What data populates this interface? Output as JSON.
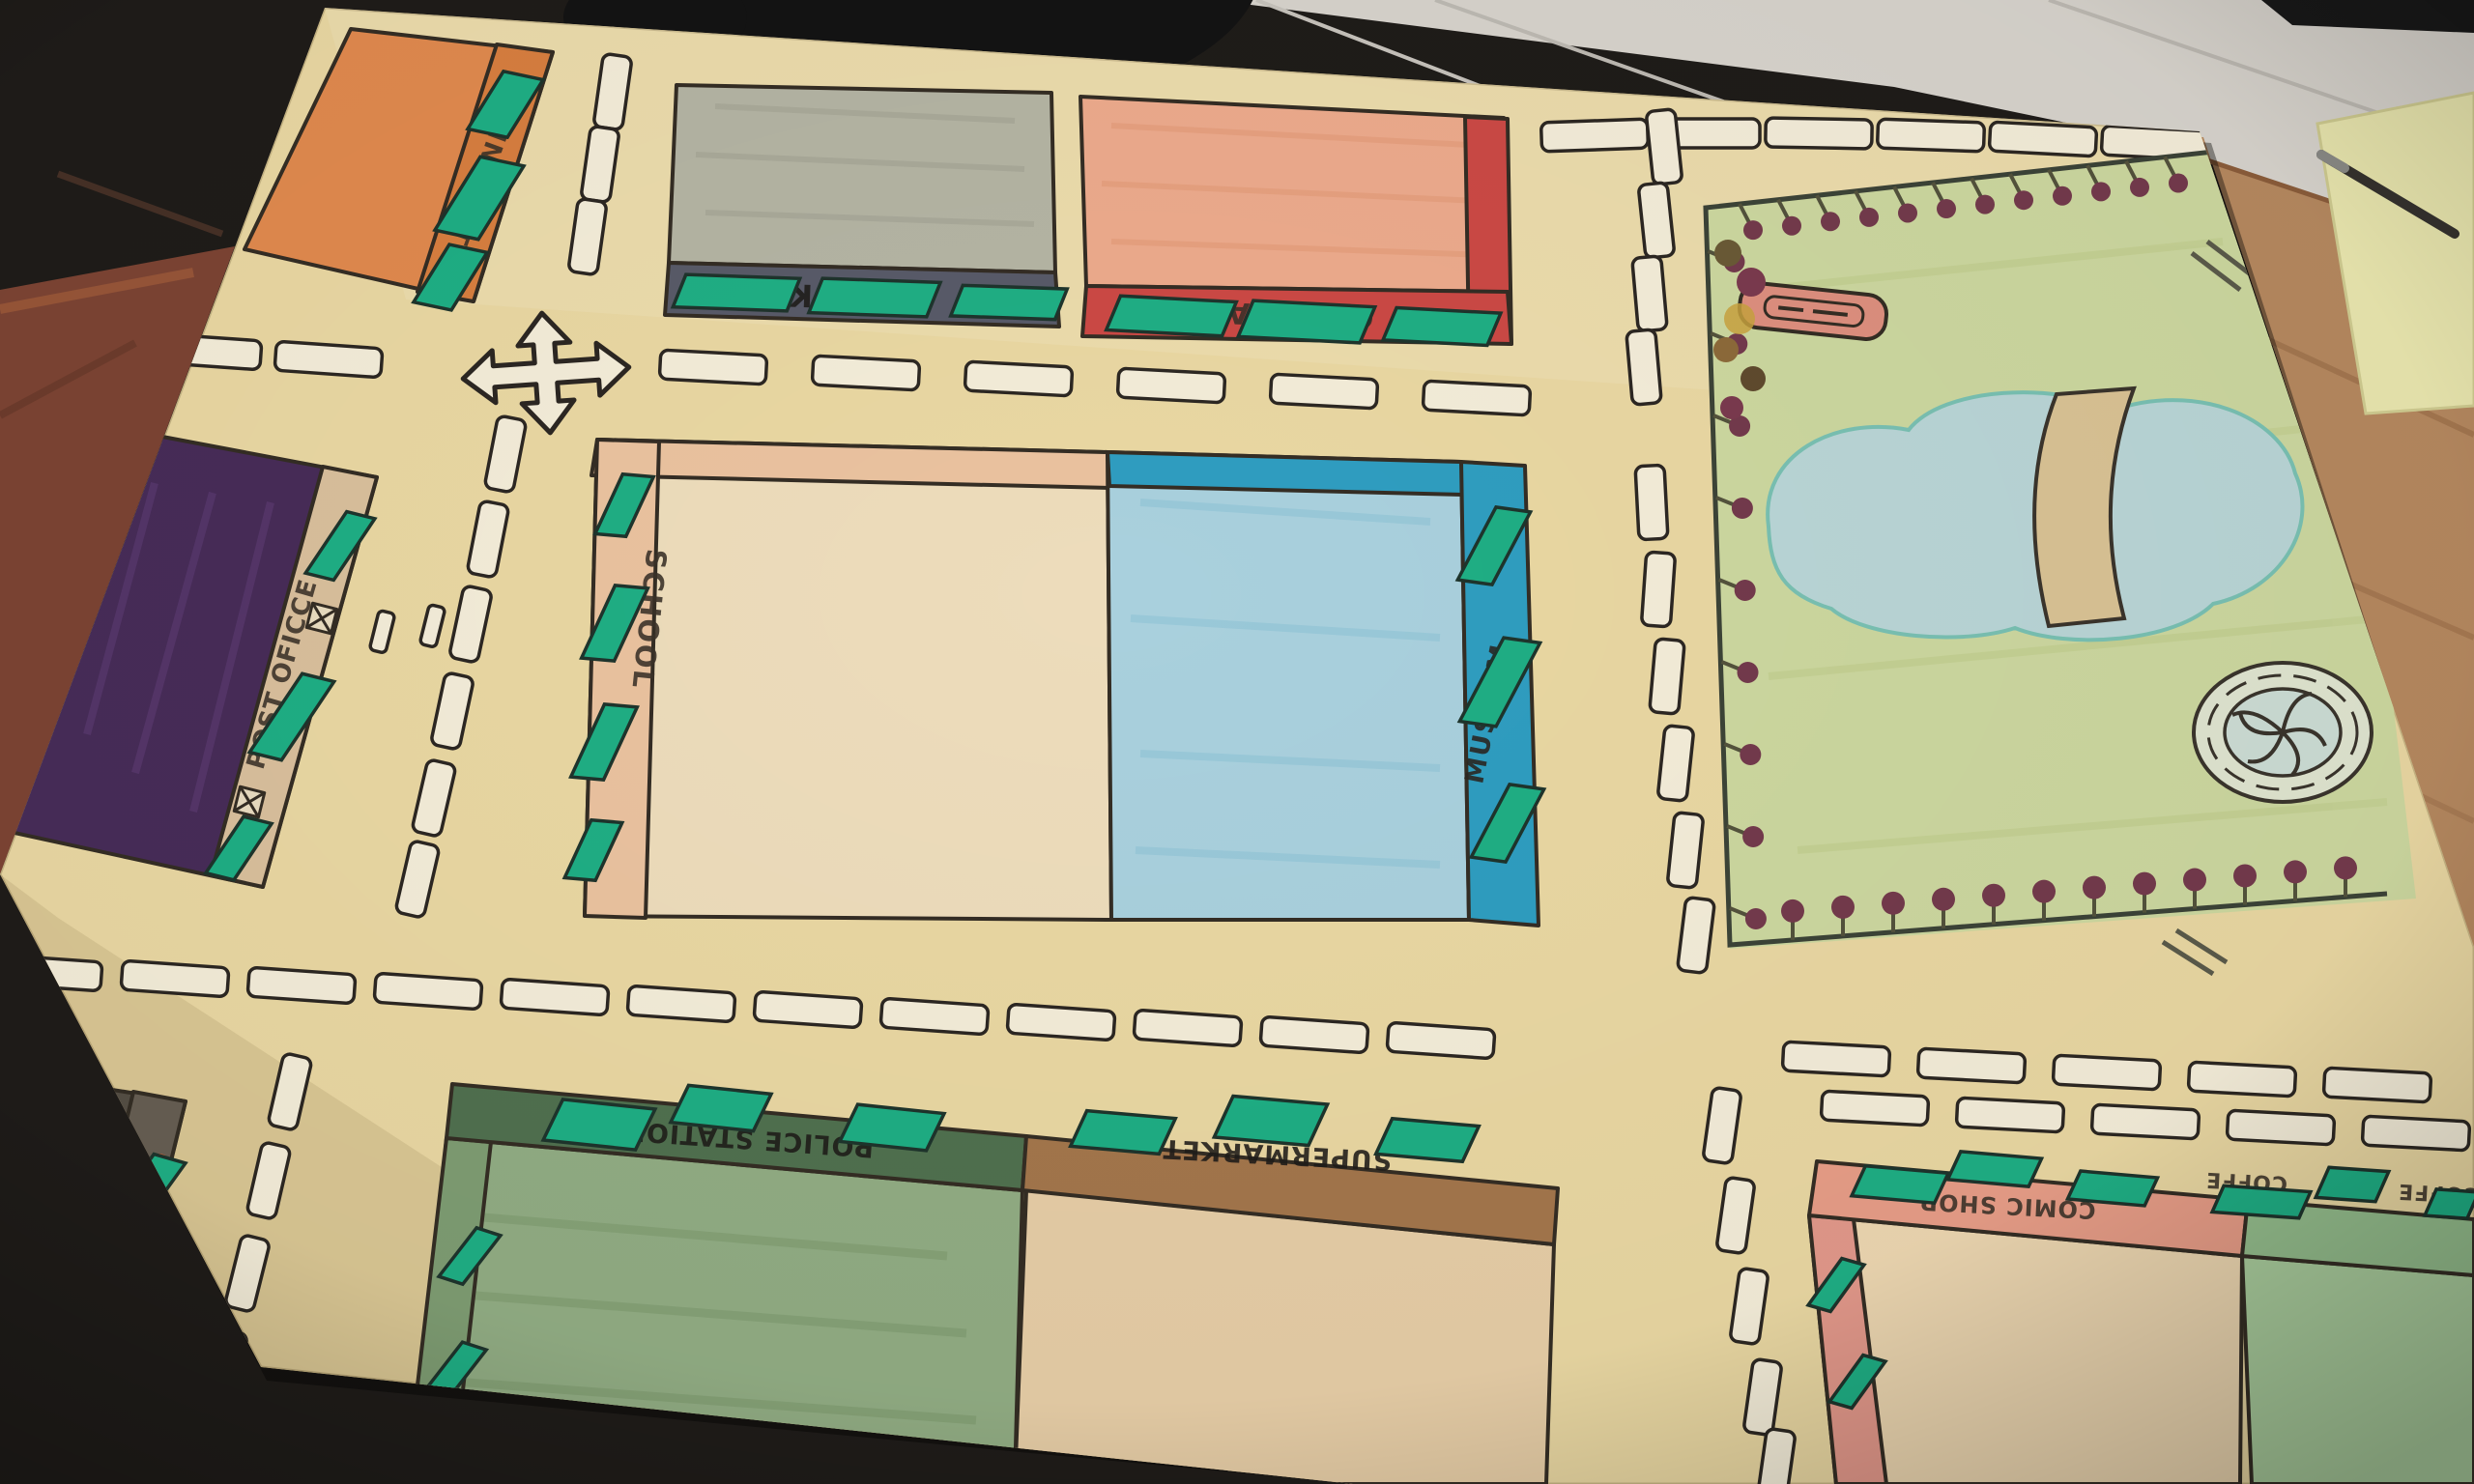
{
  "labels": {
    "train_station": "TRAIN STATION",
    "bank": "BANK",
    "cinema": "CINEMA",
    "post_office": "POST OFICCE",
    "school": "SCHOOL",
    "museum": "MUSEUM",
    "police_station": "POLICE STATION",
    "supermarket": "SUPERMARKET",
    "chemist": "CHEMIST",
    "comic_shop": "COMIC SHOP",
    "coffee_1": "COFFE",
    "coffee_2": "COFFE"
  },
  "colors": {
    "poster": "#e9d7a2",
    "ink": "#342d24",
    "text": "#3a3128",
    "window": "#1fae84",
    "dash": "#f3ecd8",
    "train": "#e0894e",
    "train_strip": "#d77e3f",
    "bank": "#b4b4a3",
    "bank_strip": "#585a68",
    "cinema": "#ecaa8c",
    "cinema_strip": "#cb4945",
    "post": "#472c58",
    "post_strip": "#d9bf9c",
    "school": "#eddcbb",
    "school_strip": "#eac29f",
    "museum": "#a9d0dd",
    "museum_strip": "#2f9dc0",
    "police": "#91ac83",
    "police_strip": "#50704f",
    "market": "#e6cda6",
    "market_strip": "#a3764c",
    "comic": "#ecd6b0",
    "comic_strip": "#e79d87",
    "coffee": "#a9cc9c",
    "coffee_strip": "#94bd8c",
    "chemist": "#554e44",
    "chemist_strip": "#665e52",
    "park": "#ccd79f",
    "pond": "#b9d5d6",
    "pond_edge": "#79c0b2",
    "bridge": "#d9c294",
    "tree": "#733a4c",
    "desk": "#b5885f",
    "desk_left": "#7c4433",
    "floor": "#d7d3cc",
    "paper": "#e9e6ae",
    "dark": "#1f1c19"
  }
}
